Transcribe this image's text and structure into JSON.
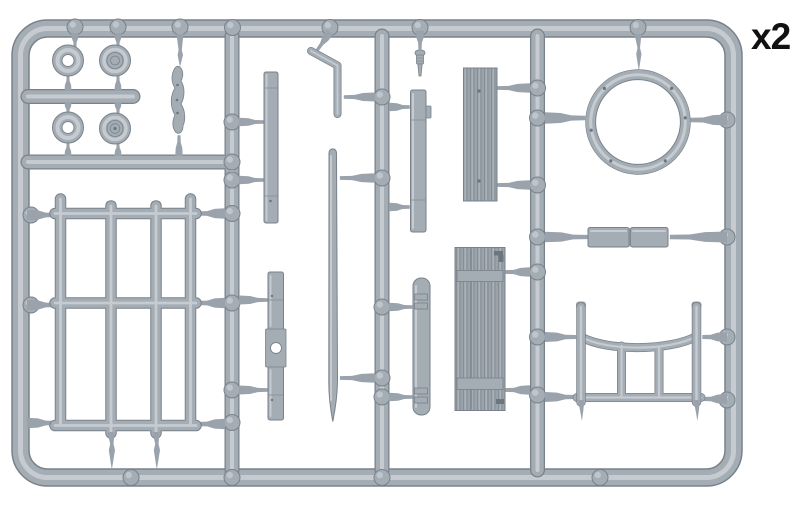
{
  "label": {
    "text": "x2"
  },
  "colors": {
    "background": "#ffffff",
    "plastic-base": "#a4acb4",
    "plastic-light": "#cdd3d8",
    "plastic-edge": "#79828b",
    "plastic-shadow": "#8d959d",
    "gate-fill": "#9aa2ab",
    "wood-base": "#9aa2aa",
    "wood-grain": "#858d96",
    "metal-dark": "#6d757e",
    "label-text": "#111111"
  },
  "sprue": {
    "quantity_label": "x2",
    "material": "grey styrene sprue",
    "parts": [
      "sprue-frame",
      "vertical-runner",
      "horizontal-runner",
      "wheel-ring",
      "pulley-wheel",
      "hand-lever",
      "notched-strip",
      "crank-handle",
      "tapered-rod",
      "drilled-strip",
      "stepped-strip",
      "hinged-strip",
      "wood-plank",
      "plank-door",
      "turret-ring",
      "stowage-blocks",
      "railing-panel",
      "curved-fence-panel",
      "small-pin"
    ]
  }
}
